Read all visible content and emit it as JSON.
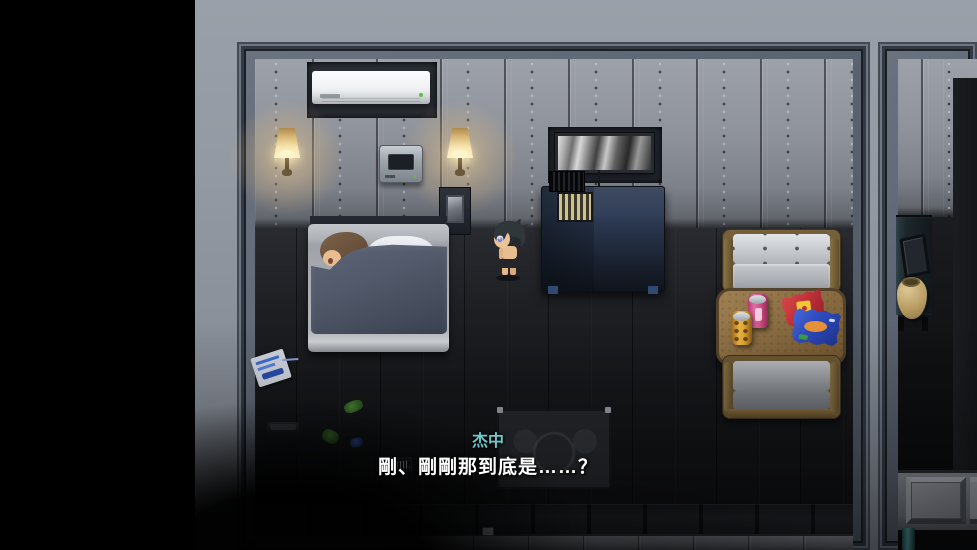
{
  "window": {
    "width_px": 977,
    "height_px": 550
  },
  "dialogue": {
    "speaker_name": "杰中",
    "line": "剛、剛剛那到底是……？"
  },
  "colors": {
    "speaker_name_text": "#6fc9cc",
    "dialogue_text": "#ffffff",
    "letterbox": "#000000",
    "lamp_glow": "#ffd88c",
    "metal_wall": "#8e929a",
    "blanket": "#4e5566",
    "table_wood": "#8a6c42",
    "can_pink": "#d8548c",
    "can_yellow": "#ecb544",
    "chip_bag_red": "#c03038",
    "chip_bag_blue": "#2f4cc0"
  },
  "scene_objects": [
    "air-conditioner",
    "wall-lamp-left",
    "wall-lamp-right",
    "intercom-panel",
    "wall-picture",
    "photo-stand",
    "bed",
    "sleeping-character",
    "player-character",
    "dresser",
    "radiator-grille",
    "sofa-top",
    "sofa-bottom",
    "coffee-table",
    "soda-can-pink",
    "soda-can-yellow",
    "chip-bag-red",
    "chip-bag-blue",
    "floor-rug",
    "trash-bin",
    "magazine",
    "litter",
    "barcode-slip",
    "light-switch",
    "side-shelf",
    "leaning-frame",
    "clay-jug",
    "wall-pipe"
  ]
}
